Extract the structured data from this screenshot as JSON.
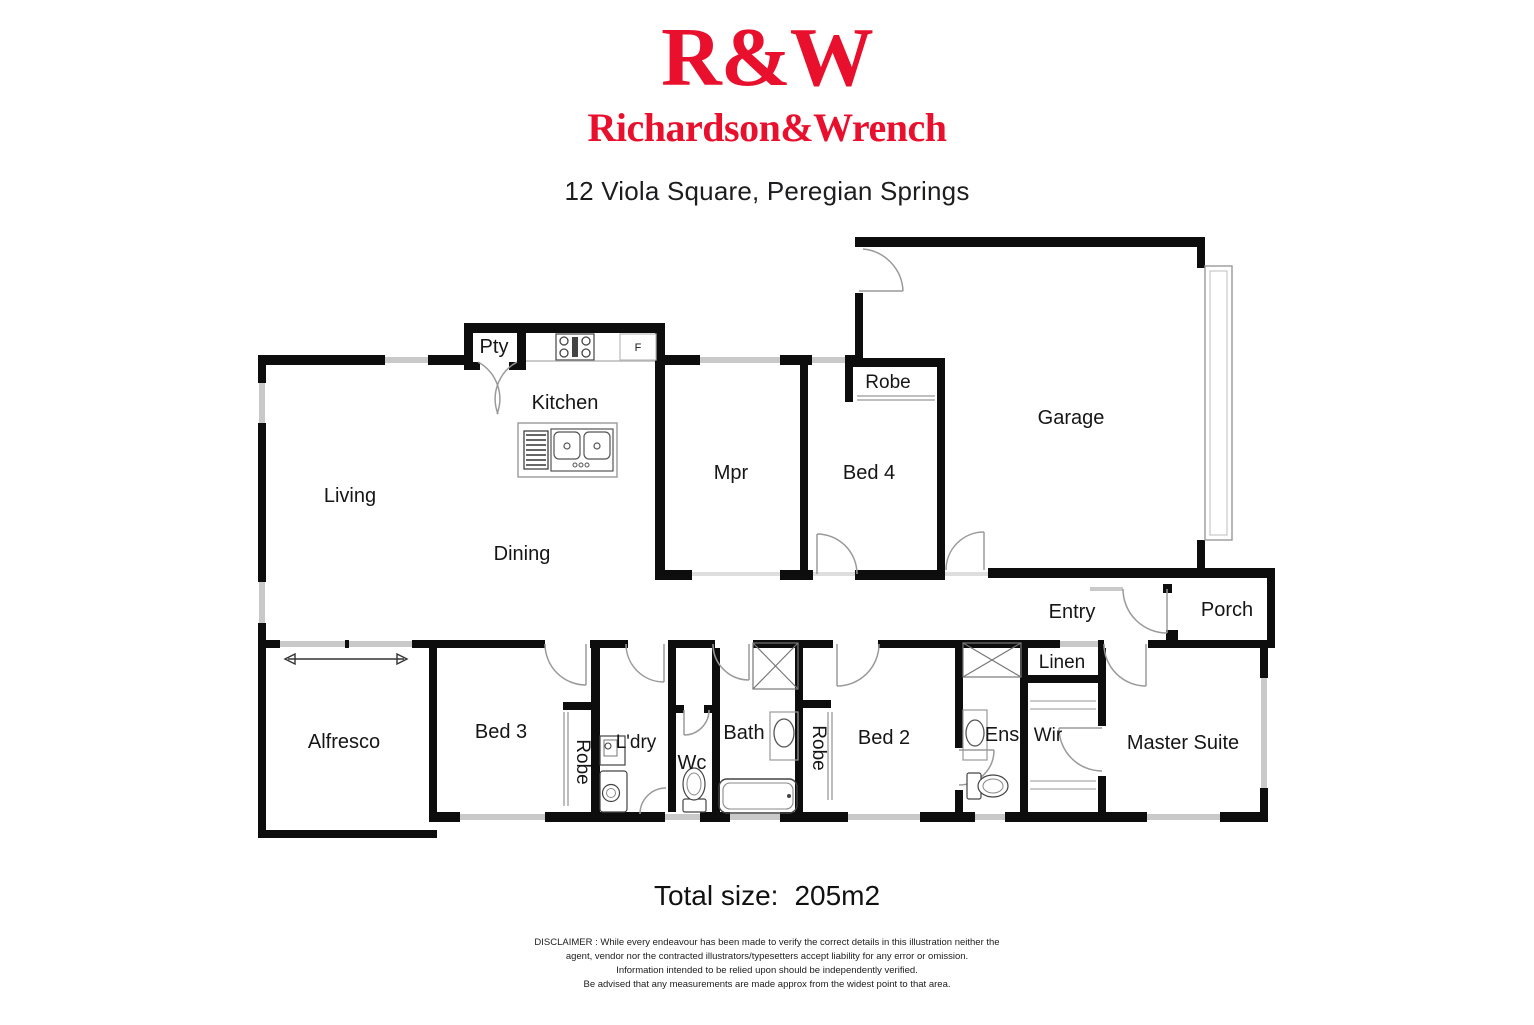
{
  "header": {
    "logo_primary": "R&W",
    "logo_secondary": "Richardson&Wrench",
    "brand_color": "#e8102d",
    "address": "12 Viola Square, Peregian Springs"
  },
  "floorplan": {
    "wall_color": "#0d0d0d",
    "window_color": "#c9c9c9",
    "door_arc_color": "#9a9a9a",
    "rooms": {
      "pty": "Pty",
      "kitchen": "Kitchen",
      "fridge": "F",
      "living": "Living",
      "dining": "Dining",
      "mpr": "Mpr",
      "bed4": "Bed 4",
      "robe_bed4": "Robe",
      "garage": "Garage",
      "entry": "Entry",
      "porch": "Porch",
      "linen": "Linen",
      "wir": "Wir",
      "master": "Master Suite",
      "ens": "Ens",
      "bed2": "Bed 2",
      "robe_bed2": "Robe",
      "bath": "Bath",
      "wc": "Wc",
      "laundry": "L'dry",
      "bed3": "Bed 3",
      "robe_bed3": "Robe",
      "alfresco": "Alfresco"
    }
  },
  "footer": {
    "total_size_label": "Total size:",
    "total_size_value": "205m2",
    "disclaimer_lines": [
      "DISCLAIMER : While every endeavour has been made to verify the correct details in this illustration neither the",
      "agent, vendor nor the contracted illustrators/typesetters accept liability for any error or omission.",
      "Information intended to be relied upon should be independently verified.",
      "Be advised that any measurements are made approx from the widest point to that area."
    ]
  }
}
